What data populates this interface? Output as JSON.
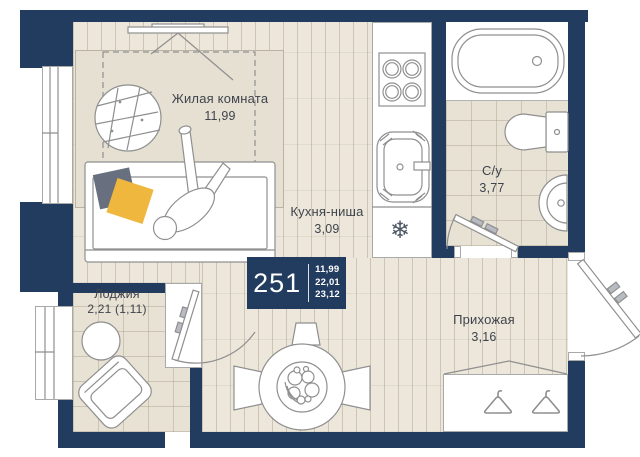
{
  "unit": {
    "number": "251",
    "area_living": "11,99",
    "area_total": "22,01",
    "area_full": "23,12"
  },
  "rooms": {
    "living": {
      "name": "Жилая комната",
      "area": "11,99"
    },
    "kitchen": {
      "name": "Кухня-ниша",
      "area": "3,09"
    },
    "bathroom": {
      "name": "С/у",
      "area": "3,77"
    },
    "hallway": {
      "name": "Прихожая",
      "area": "3,16"
    },
    "loggia": {
      "name": "Лоджия",
      "area": "2,21 (1,11)"
    }
  },
  "icons": {
    "fridge_snowflake": "❄"
  },
  "colors": {
    "wall": "#223c5f",
    "floor": "#ece7da",
    "pillow_gray": "#68707f",
    "pillow_yellow": "#efb73e"
  }
}
